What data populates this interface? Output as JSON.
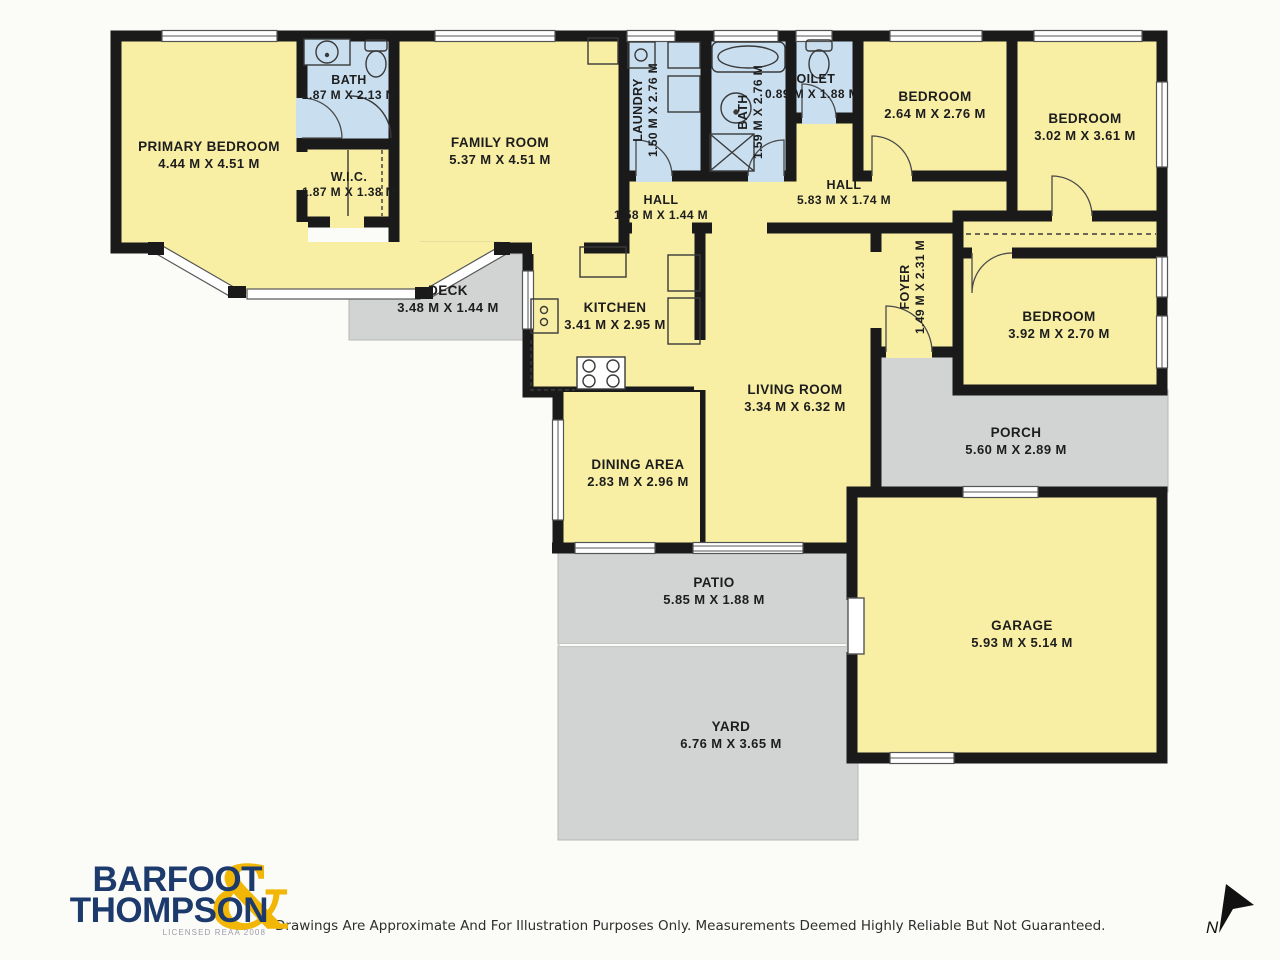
{
  "plan": {
    "rooms": [
      {
        "name": "PRIMARY BEDROOM",
        "dims": "4.44 M X 4.51 M"
      },
      {
        "name": "BATH",
        "dims": "1.87 M X 2.13 M"
      },
      {
        "name": "W.I.C.",
        "dims": "1.87 M X 1.38 M"
      },
      {
        "name": "FAMILY ROOM",
        "dims": "5.37 M X 4.51 M"
      },
      {
        "name": "LAUNDRY",
        "dims": "1.50 M X 2.76 M"
      },
      {
        "name": "BATH",
        "dims": "1.59 M X 2.76 M"
      },
      {
        "name": "TOILET",
        "dims": "0.89 M X 1.88 M"
      },
      {
        "name": "BEDROOM",
        "dims": "2.64 M X 2.76 M"
      },
      {
        "name": "BEDROOM",
        "dims": "3.02 M X 3.61 M"
      },
      {
        "name": "HALL",
        "dims": "1.58 M X 1.44 M"
      },
      {
        "name": "HALL",
        "dims": "5.83 M X 1.74 M"
      },
      {
        "name": "FOYER",
        "dims": "1.49 M X 2.31 M"
      },
      {
        "name": "BEDROOM",
        "dims": "3.92 M X 2.70 M"
      },
      {
        "name": "DECK",
        "dims": "3.48 M X 1.44 M"
      },
      {
        "name": "KITCHEN",
        "dims": "3.41 M X 2.95 M"
      },
      {
        "name": "LIVING ROOM",
        "dims": "3.34 M X 6.32 M"
      },
      {
        "name": "DINING AREA",
        "dims": "2.83 M X 2.96 M"
      },
      {
        "name": "PORCH",
        "dims": "5.60 M X 2.89 M"
      },
      {
        "name": "PATIO",
        "dims": "5.85 M X 1.88 M"
      },
      {
        "name": "GARAGE",
        "dims": "5.93 M X 5.14 M"
      },
      {
        "name": "YARD",
        "dims": "6.76 M X 3.65 M"
      }
    ],
    "colors": {
      "room_fill": "#f8efa5",
      "wet_room_fill": "#c9dff0",
      "outdoor_fill": "#d2d4d3",
      "wall": "#1a1a1a",
      "logo_navy": "#1d3a6d",
      "logo_gold": "#f2b705"
    },
    "compass": {
      "label": "N"
    }
  },
  "footer": {
    "logo": {
      "line1": "BARFOOT",
      "line2": "THOMPSON",
      "ampersand": "&",
      "license": "LICENSED REAA 2008"
    },
    "disclaimer": "Drawings Are Approximate And For Illustration Purposes Only. Measurements Deemed Highly Reliable But Not Guaranteed."
  }
}
